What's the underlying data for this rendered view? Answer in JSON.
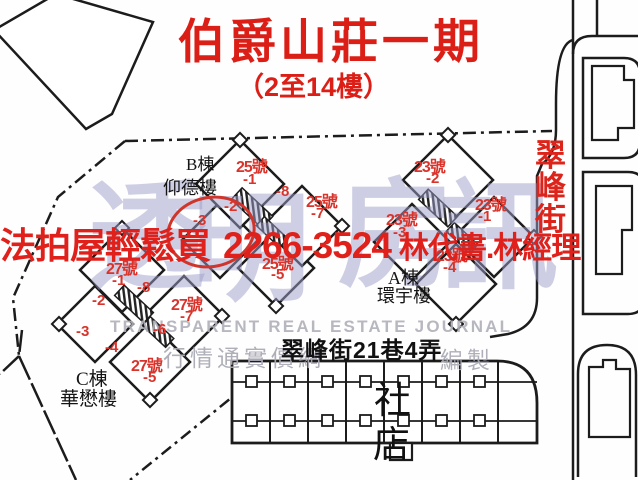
{
  "title": "伯爵山莊一期",
  "subtitle": "（2至14樓）",
  "banner": {
    "slogan": "法拍屋輕鬆買",
    "phone": "2266-3524",
    "agents": "林代書.林經理"
  },
  "streets": {
    "main": "翠峰街",
    "lane": "翠峰街21巷4弄"
  },
  "buildings": {
    "b": {
      "label": "B棟",
      "name": "仰德樓",
      "units": {
        "no1": "25號",
        "u1": "-1",
        "u8": "-8",
        "no2": "25號",
        "u7": "-7",
        "u2": "-2",
        "u3": "-3",
        "no3": "25號",
        "u5": "-5"
      }
    },
    "a": {
      "label": "A棟",
      "name": "環宇樓",
      "units": {
        "no1": "23號",
        "u2": "-2",
        "no2": "23號",
        "u1": "-1",
        "no3": "23號",
        "u3": "-3",
        "no4": "23號",
        "u4": "-4"
      }
    },
    "c": {
      "label": "C棟",
      "name": "華懋樓",
      "units": {
        "no1": "27號",
        "u1": "-1",
        "u8": "-8",
        "u2": "-2",
        "no2": "27號",
        "u7": "-7",
        "u6": "-6",
        "u3": "-3",
        "u4": "-4",
        "no3": "27號",
        "u5": "-5"
      }
    }
  },
  "community_hall": {
    "line1": "社",
    "line2": "店"
  },
  "watermark": {
    "brand": [
      "透",
      "明",
      "房",
      "訊"
    ],
    "english": "TRANSPARENT REAL ESTATE JOURNAL",
    "cjk": "行情通實價網",
    "cjk2": "編製"
  },
  "colors": {
    "red_accent": "#e0201a",
    "unit_red": "#d8342c",
    "lavender": "#9e9ecb",
    "watermark_gray": "#b0b0ba",
    "ink": "#1c1c1c"
  }
}
